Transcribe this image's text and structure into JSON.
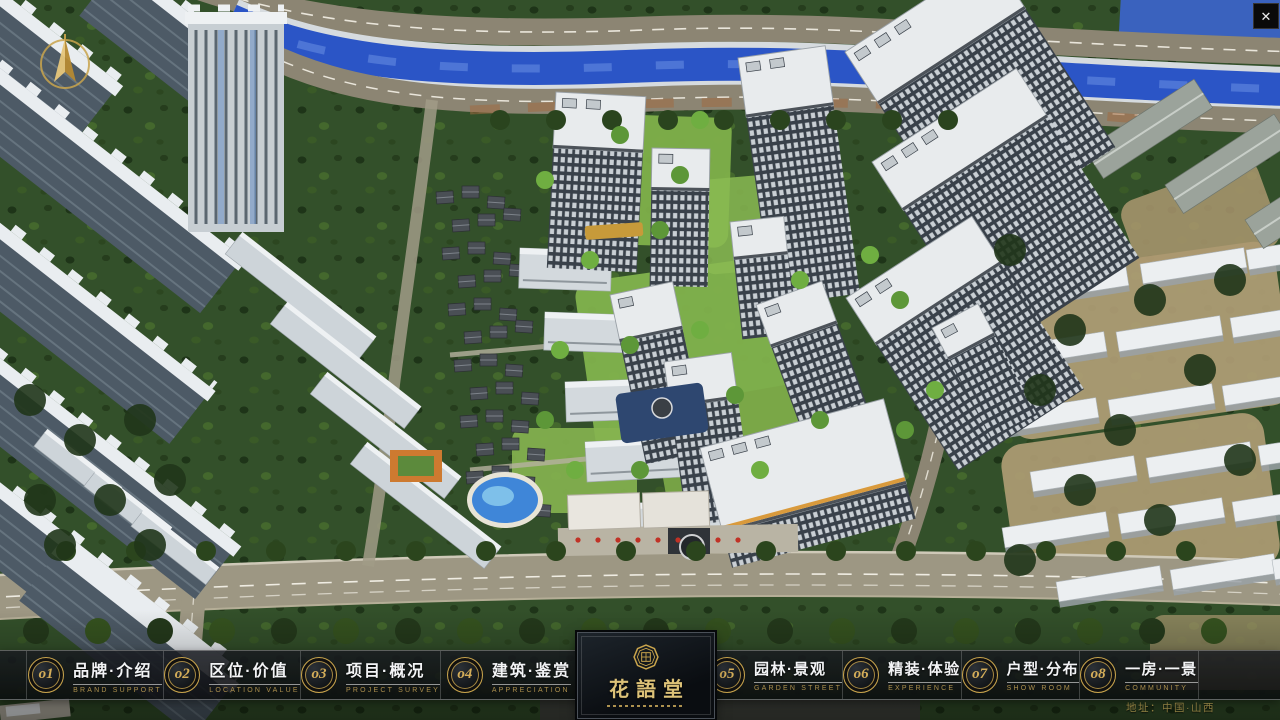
{
  "window": {
    "close_glyph": "✕"
  },
  "nav": {
    "items": [
      {
        "num": "o1",
        "title": "品牌·介绍",
        "subtitle": "BRAND SUPPORT"
      },
      {
        "num": "o2",
        "title": "区位·价值",
        "subtitle": "LOCATION VALUE"
      },
      {
        "num": "o3",
        "title": "项目·概况",
        "subtitle": "PROJECT SURVEY"
      },
      {
        "num": "o4",
        "title": "建筑·鉴赏",
        "subtitle": "APPRECIATION"
      },
      {
        "num": "o5",
        "title": "园林·景观",
        "subtitle": "GARDEN STREET"
      },
      {
        "num": "o6",
        "title": "精装·体验",
        "subtitle": "EXPERIENCE"
      },
      {
        "num": "o7",
        "title": "户型·分布",
        "subtitle": "SHOW ROOM"
      },
      {
        "num": "o8",
        "title": "一房·一景",
        "subtitle": "COMMUNITY"
      }
    ]
  },
  "logo": {
    "title": "花語堂"
  },
  "footer": {
    "address": "地址：中国·山西"
  },
  "colors": {
    "gold": "#c9a44c",
    "bar_bg": "rgba(14,16,20,0.76)",
    "river": "#2b55c6",
    "road": "#8c8573",
    "lawn": "#7fb04a",
    "roof_white": "#e8ebed",
    "facade_dark": "#39414a",
    "accent_red": "#c03226"
  }
}
